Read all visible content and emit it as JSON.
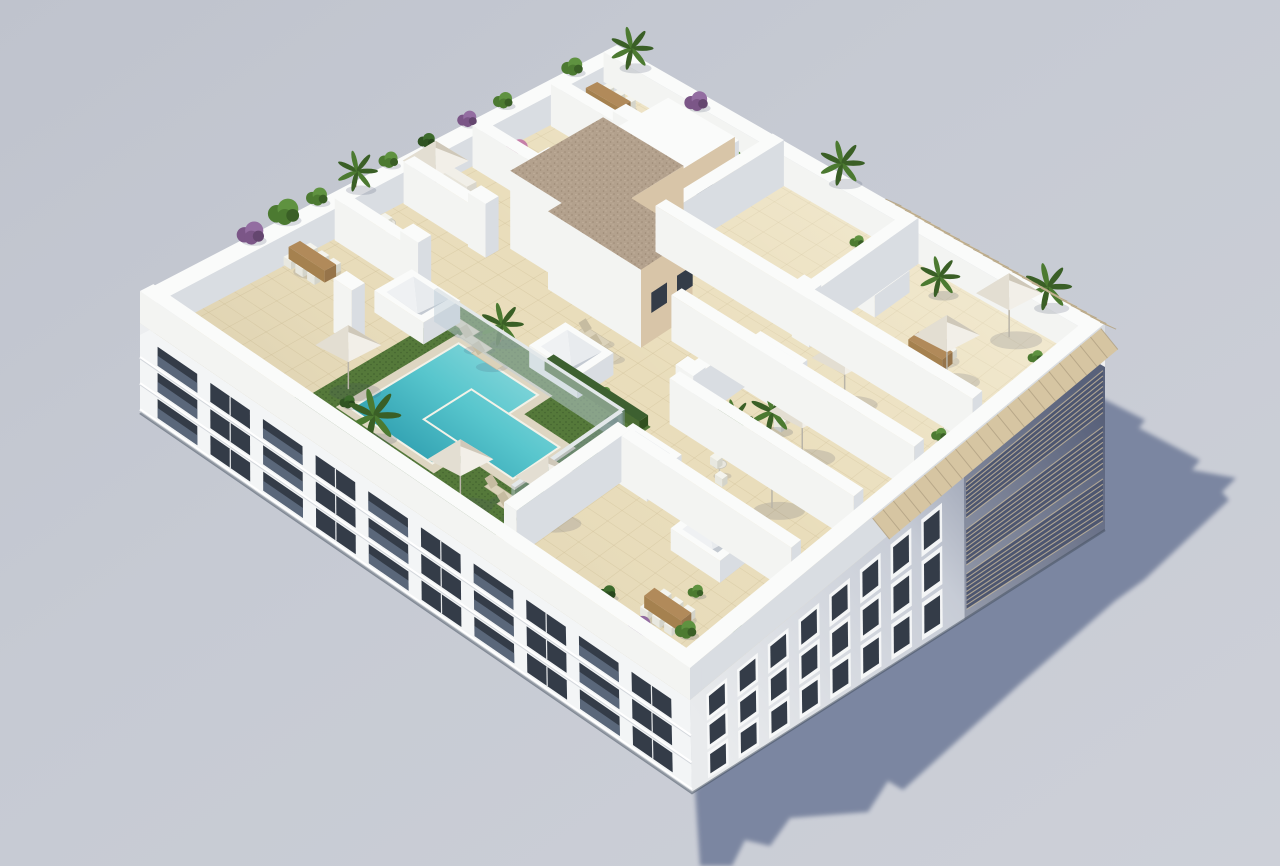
{
  "scene": {
    "subject": "aerial 3d render of apartment building rooftop terrace with communal pool",
    "colors": {
      "bg_top": "#c0c4ce",
      "bg_bottom": "#cdd0d8",
      "shadow": "#717d9a",
      "wall_top": "#fafbfa",
      "wall_lit": "#f3f4f2",
      "wall_shade": "#d9dde2",
      "facade_sw": "#f3f5f6",
      "facade_se_light": "#e9ebed",
      "facade_se_dark": "#68718a",
      "window_dark": "#343c48",
      "glass": "#67768b",
      "frame": "#f8f9fa",
      "tile": "#e9ddbb",
      "tile_line": "#d2c29a",
      "deck": "#ded6c2",
      "grass": "#55793a",
      "grass_dark": "#446430",
      "pool_light": "#8fdadd",
      "pool_mid": "#58c6cd",
      "pool_deep": "#2f9fb0",
      "pool_edge": "#f3f2e8",
      "gravel": "#b3a18d",
      "gravel_dot": "#9d8a76",
      "core_beige": "#d8c5a8",
      "umb_light": "#f2efe8",
      "umb_mid": "#e3ded2",
      "umb_dark": "#cfc8b9",
      "umb_mid2": "#dad4c6",
      "wood": "#b18a5a",
      "wood_dark": "#96744a",
      "louver": "#d6c5a2",
      "louver_dark": "#b1a183",
      "lounger": "#dbd2ba",
      "lounger_dark": "#c6bca1",
      "trunk": "#8a6f52",
      "pot": "#e2ded4",
      "green": [
        "#4c7a31",
        "#5f9240",
        "#3a5f26"
      ],
      "dark": [
        "#2f5322",
        "#3d6b2c",
        "#27471d"
      ],
      "purple": [
        "#7b5687",
        "#936da1",
        "#64466f"
      ],
      "pink": [
        "#b06794",
        "#c57fa8",
        "#8f537a"
      ]
    },
    "shadow_points": [
      [
        695,
        790
      ],
      [
        1090,
        392
      ],
      [
        1145,
        420
      ],
      [
        1139,
        428
      ],
      [
        1200,
        460
      ],
      [
        1192,
        470
      ],
      [
        1236,
        478
      ],
      [
        1222,
        492
      ],
      [
        1229,
        500
      ],
      [
        1144,
        580
      ],
      [
        1115,
        601
      ],
      [
        1020,
        684
      ],
      [
        998,
        704
      ],
      [
        903,
        790
      ],
      [
        888,
        781
      ],
      [
        868,
        812
      ],
      [
        790,
        818
      ],
      [
        770,
        846
      ],
      [
        745,
        840
      ],
      [
        732,
        866
      ],
      [
        700,
        866
      ]
    ],
    "facade_sw": {
      "floors": 3,
      "bays": 10
    },
    "facade_se": {
      "rows": 3,
      "window_cols": 8
    },
    "grass": [
      0.245,
      0.032,
      0.605,
      0.405
    ],
    "deck": [
      [
        0.285,
        0.085,
        0.465,
        0.35
      ],
      [
        0.365,
        0.148,
        0.562,
        0.287
      ]
    ],
    "pool": [
      [
        0.3,
        0.1,
        0.45,
        0.335
      ],
      [
        0.38,
        0.165,
        0.545,
        0.27
      ]
    ],
    "hedges": [
      [
        0.25,
        0.032,
        0.59,
        0.052
      ],
      [
        0.42,
        0.385,
        0.6,
        0.405
      ]
    ],
    "parapets": {
      "h_back": 30,
      "h_front": 32,
      "t": 0.028
    },
    "walls": [
      {
        "r": [
          0.03,
          0.375,
          0.175,
          0.398
        ],
        "h": 42
      },
      {
        "r": [
          0.03,
          0.52,
          0.175,
          0.543
        ],
        "h": 42
      },
      {
        "r": [
          0.03,
          0.665,
          0.175,
          0.688
        ],
        "h": 42
      },
      {
        "r": [
          0.03,
          0.83,
          0.175,
          0.853
        ],
        "h": 42
      },
      {
        "r": [
          0.62,
          0.43,
          0.972,
          0.453
        ],
        "h": 46
      },
      {
        "r": [
          0.5,
          0.575,
          0.972,
          0.598
        ],
        "h": 46
      },
      {
        "r": [
          0.345,
          0.715,
          0.972,
          0.738
        ],
        "h": 46
      },
      {
        "r": [
          0.345,
          0.738,
          0.368,
          0.972
        ],
        "h": 46
      },
      {
        "r": [
          0.62,
          0.738,
          0.643,
          0.972
        ],
        "h": 46
      },
      {
        "r": [
          0.62,
          0.453,
          0.643,
          0.575
        ],
        "h": 46
      },
      {
        "r": [
          0.63,
          0.04,
          0.653,
          0.3
        ],
        "h": 46
      },
      {
        "r": [
          0.653,
          0.28,
          0.972,
          0.303
        ],
        "h": 46
      },
      {
        "r": [
          0.245,
          0.345,
          0.6,
          0.352
        ],
        "h": 32,
        "glass": true
      },
      {
        "r": [
          0.595,
          0.1,
          0.602,
          0.345
        ],
        "h": 32,
        "glass": true
      }
    ],
    "cores": [
      {
        "r": [
          0.2,
          0.56,
          0.36,
          0.76
        ],
        "h": 78,
        "roof": "gravel",
        "win": 1
      },
      {
        "r": [
          0.3,
          0.53,
          0.48,
          0.645
        ],
        "h": 78,
        "roof": "gravel",
        "win": 2
      },
      {
        "r": [
          0.2,
          0.76,
          0.335,
          0.9
        ],
        "h": 60,
        "roof": "white",
        "win": 1
      }
    ],
    "skylights": [
      [
        0.224,
        0.333
      ],
      [
        0.447,
        0.413
      ],
      [
        0.655,
        0.61
      ],
      [
        0.234,
        0.928
      ],
      [
        0.632,
        0.872
      ],
      [
        0.659,
        0.315
      ],
      [
        0.839,
        0.261
      ]
    ],
    "pillars": [
      [
        0.19,
        0.225
      ],
      [
        0.175,
        0.385
      ],
      [
        0.175,
        0.53
      ],
      [
        0.175,
        0.675
      ],
      [
        0.175,
        0.84
      ],
      [
        0.635,
        0.46
      ],
      [
        0.635,
        0.725
      ]
    ],
    "umbrellas": [
      [
        0.27,
        0.13
      ],
      [
        0.53,
        0.065
      ],
      [
        0.635,
        0.135
      ],
      [
        0.84,
        0.4
      ],
      [
        0.8,
        0.52
      ],
      [
        0.77,
        0.655
      ],
      [
        0.85,
        0.8
      ],
      [
        0.86,
        0.935
      ],
      [
        0.06,
        0.555
      ]
    ],
    "loungers": [
      [
        0.285,
        0.362
      ],
      [
        0.322,
        0.347
      ],
      [
        0.358,
        0.332
      ],
      [
        0.425,
        0.49
      ],
      [
        0.458,
        0.475
      ],
      [
        0.56,
        0.12
      ],
      [
        0.595,
        0.105
      ],
      [
        0.745,
        0.505
      ],
      [
        0.778,
        0.49
      ]
    ],
    "wood_tables": [
      [
        0.055,
        0.3
      ],
      [
        0.05,
        0.93
      ],
      [
        0.8,
        0.82
      ],
      [
        0.875,
        0.11
      ]
    ],
    "round_tables": [
      [
        0.065,
        0.45
      ],
      [
        0.085,
        0.72
      ],
      [
        0.74,
        0.4
      ],
      [
        0.725,
        0.555
      ],
      [
        0.92,
        0.72
      ]
    ],
    "sofas": [
      [
        0.03,
        0.87
      ],
      [
        0.05,
        0.615
      ],
      [
        0.705,
        0.77
      ]
    ],
    "plants": [
      {
        "t": "purple",
        "a": 0.005,
        "b": 0.225,
        "s": 1.4,
        "e": 30
      },
      {
        "t": "green",
        "a": 0.0,
        "b": 0.3,
        "s": 1.6,
        "e": 30
      },
      {
        "t": "green",
        "a": 0.0,
        "b": 0.37,
        "s": 1.1,
        "e": 30
      },
      {
        "t": "palm",
        "a": 0.01,
        "b": 0.44,
        "s": 0.95,
        "e": 30
      },
      {
        "t": "green",
        "a": 0.0,
        "b": 0.52,
        "s": 1.0,
        "e": 30
      },
      {
        "t": "dark",
        "a": 0.0,
        "b": 0.6,
        "s": 0.9,
        "e": 30
      },
      {
        "t": "purple",
        "a": 0.0,
        "b": 0.685,
        "s": 1.0,
        "e": 30
      },
      {
        "t": "green",
        "a": 0.0,
        "b": 0.76,
        "s": 1.0,
        "e": 30
      },
      {
        "t": "pink",
        "a": 0.12,
        "b": 0.66,
        "s": 1.25,
        "e": 42
      },
      {
        "t": "green",
        "a": 0.005,
        "b": 0.9,
        "s": 1.1,
        "e": 30
      },
      {
        "t": "palm",
        "a": 0.05,
        "b": 0.975,
        "s": 1.0,
        "e": 30
      },
      {
        "t": "purple",
        "a": 0.19,
        "b": 0.97,
        "s": 1.2,
        "e": 30
      },
      {
        "t": "green",
        "a": 0.28,
        "b": 0.955,
        "s": 0.9,
        "e": 0,
        "pot": true
      },
      {
        "t": "green",
        "a": 0.22,
        "b": 0.9,
        "s": 0.7,
        "e": 0,
        "pot": true
      },
      {
        "t": "palm",
        "a": 0.47,
        "b": 0.985,
        "s": 1.05,
        "e": 30
      },
      {
        "t": "green",
        "a": 0.35,
        "b": 0.93,
        "s": 0.7,
        "e": 0,
        "pot": true
      },
      {
        "t": "green",
        "a": 0.55,
        "b": 0.935,
        "s": 0.75,
        "e": 0,
        "pot": true
      },
      {
        "t": "green",
        "a": 0.62,
        "b": 0.96,
        "s": 0.8,
        "e": 0,
        "pot": true
      },
      {
        "t": "palm",
        "a": 0.71,
        "b": 0.94,
        "s": 0.95,
        "e": 0
      },
      {
        "t": "palm",
        "a": 0.9,
        "b": 0.975,
        "s": 1.1,
        "e": 30
      },
      {
        "t": "green",
        "a": 0.93,
        "b": 0.915,
        "s": 0.8,
        "e": 0,
        "pot": true
      },
      {
        "t": "palm",
        "a": 0.335,
        "b": 0.385,
        "s": 1.0,
        "e": 0
      },
      {
        "t": "palm",
        "a": 0.4,
        "b": 0.025,
        "s": 1.25,
        "e": 30
      },
      {
        "t": "palm",
        "a": 0.73,
        "b": 0.53,
        "s": 1.05,
        "e": 0
      },
      {
        "t": "palm",
        "a": 0.695,
        "b": 0.485,
        "s": 0.85,
        "e": 0
      },
      {
        "t": "green",
        "a": 0.67,
        "b": 0.63,
        "s": 0.7,
        "e": 0,
        "pot": true
      },
      {
        "t": "green",
        "a": 0.67,
        "b": 0.455,
        "s": 0.65,
        "e": 0,
        "pot": true
      },
      {
        "t": "green",
        "a": 0.7,
        "b": 0.76,
        "s": 0.7,
        "e": 0,
        "pot": true
      },
      {
        "t": "green",
        "a": 0.74,
        "b": 0.31,
        "s": 0.7,
        "e": 0,
        "pot": true
      },
      {
        "t": "green",
        "a": 0.93,
        "b": 0.685,
        "s": 0.8,
        "e": 0,
        "pot": true
      },
      {
        "t": "purple",
        "a": 0.865,
        "b": 0.055,
        "s": 1.2,
        "e": 0
      },
      {
        "t": "green",
        "a": 0.915,
        "b": 0.1,
        "s": 1.1,
        "e": 0
      },
      {
        "t": "green",
        "a": 0.955,
        "b": 0.16,
        "s": 1.0,
        "e": 0
      },
      {
        "t": "dark",
        "a": 0.79,
        "b": 0.075,
        "s": 0.9,
        "e": 0
      },
      {
        "t": "green",
        "a": 0.875,
        "b": 0.175,
        "s": 0.8,
        "e": 0
      },
      {
        "t": "dark",
        "a": 0.335,
        "b": 0.05,
        "s": 0.8,
        "e": 30
      },
      {
        "t": "green",
        "a": 0.52,
        "b": 0.4,
        "s": 0.7,
        "e": 0,
        "pot": true
      },
      {
        "t": "dark",
        "a": 0.56,
        "b": 0.37,
        "s": 0.7,
        "e": 0
      }
    ],
    "pergolas": [
      {
        "edge": "se",
        "t0": 0.44,
        "t1": 0.99
      },
      {
        "edge": "ne",
        "t0": 0.55,
        "t1": 0.99
      }
    ]
  }
}
